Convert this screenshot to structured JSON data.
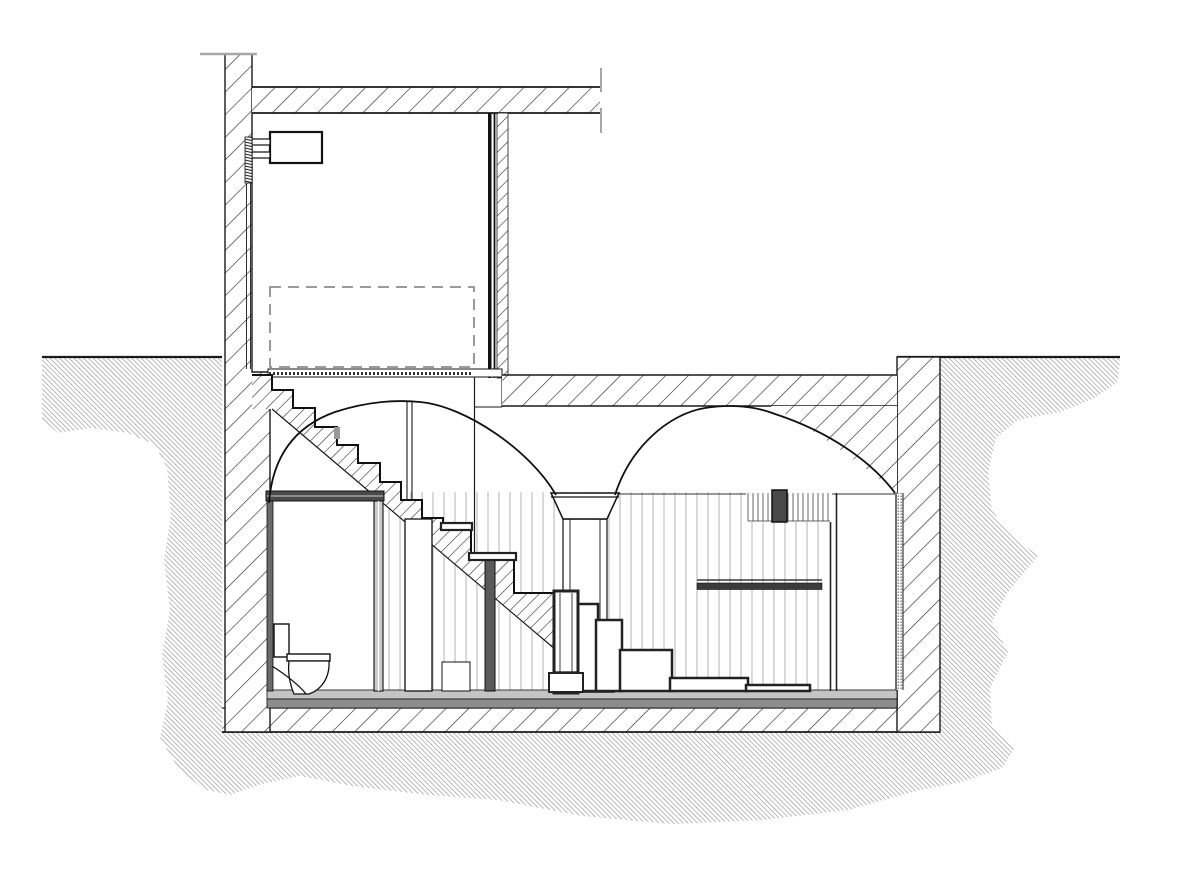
{
  "meta": {
    "title": "Basement vault section drawing",
    "drawing_type": "architectural-section",
    "visible_text": []
  },
  "palette": {
    "ink": "#1a1a1a",
    "line_dark": "#222222",
    "earth_gray": "#8f8f8f",
    "panel_gray": "#b3b3b3",
    "mid_gray": "#6a6a6a",
    "screed_light": "#c4c4c4",
    "screed_dark": "#8d8d8d",
    "railing_dark": "#3c3c3c",
    "dashed_gray": "#9a9a9a",
    "tick_gray": "#a8a8a8",
    "background": "#ffffff"
  },
  "elements": {
    "ground_surface": "grade line with hatched earth both sides",
    "upper_wall": "cut exterior wall, diagonal hatch",
    "ceiling_slab": "upper floor slab, diagonal hatch, broken at right",
    "partition": "interior partition wall on basement slab",
    "dashed_opening": "dashed projected outline in upper room",
    "cistern": "wall-mounted cistern with brackets and supply pipe",
    "vaults": "two barrel vault arches on central pier",
    "stair": "masonry flight with hatched stringer and box steps below",
    "bathroom": "enclosure with toilet in section",
    "railing": "dark handrail at right side",
    "floor": "gray screed band over hatched foundation slab"
  },
  "paneling": {
    "x0": 389,
    "step": 11,
    "count": 40,
    "y1": 492,
    "y2": 691
  },
  "louvers": {
    "x0": 748,
    "step": 5,
    "count": 17,
    "y1": 493,
    "y2": 521
  },
  "stairs": {
    "masonry_risers_x": [
      272,
      293,
      315,
      337,
      358,
      380,
      401,
      422,
      443
    ],
    "masonry_tread_y": [
      375,
      390,
      408,
      427,
      445,
      463,
      482,
      500,
      518,
      530
    ],
    "band_lower_edge": [
      [
        272,
        409
      ],
      [
        556,
        650
      ]
    ],
    "tread_bars": [
      [
        441,
        523,
        31,
        7
      ],
      [
        469,
        553,
        47,
        7
      ]
    ],
    "lower_boxes": [
      [
        577,
        604,
        21,
        87
      ],
      [
        596,
        620,
        26,
        71
      ],
      [
        620,
        650,
        52,
        41
      ],
      [
        670,
        678,
        78,
        13
      ],
      [
        746,
        685,
        64,
        6
      ]
    ]
  }
}
